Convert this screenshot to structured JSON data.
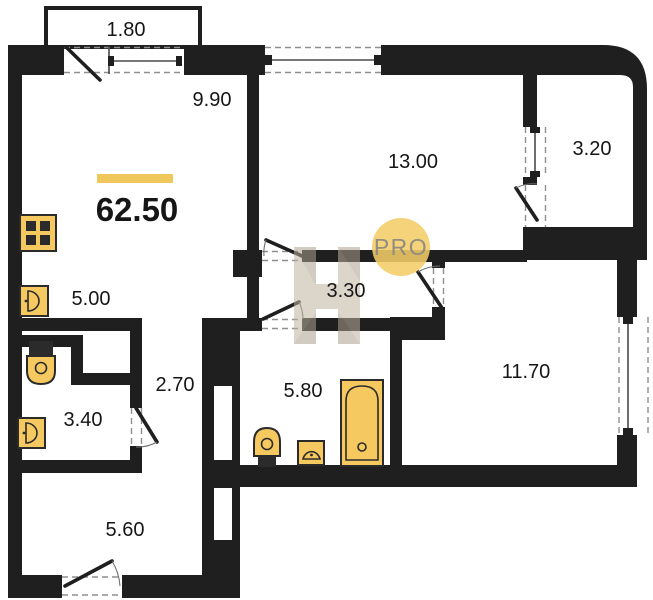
{
  "title": "Apartment floor plan",
  "total": {
    "area": "62.50"
  },
  "rooms": {
    "balcony_top": {
      "area": "1.80"
    },
    "living": {
      "area": "9.90"
    },
    "bedroom1": {
      "area": "13.00"
    },
    "balcony_right": {
      "area": "3.20"
    },
    "kitchen": {
      "area": "5.00"
    },
    "hall": {
      "area": "3.30"
    },
    "corridor": {
      "area": "2.70"
    },
    "wc": {
      "area": "3.40"
    },
    "bathroom": {
      "area": "5.80"
    },
    "bedroom2": {
      "area": "11.70"
    },
    "entry": {
      "area": "5.60"
    }
  },
  "watermark": {
    "badge": "PRO"
  },
  "icons": [
    "stove-icon",
    "sink-icon",
    "toilet-icon",
    "bathtub-icon",
    "door-swing-icon",
    "window-icon"
  ],
  "colors": {
    "wall": "#1f1f1f",
    "stroke": "#2b2b2b",
    "fixture": "#F6C860",
    "accent_bar": "#F0C75A",
    "badge": "#F2CD68",
    "badge_text": "#8D8A80",
    "watermark": "#BEB3A0"
  }
}
